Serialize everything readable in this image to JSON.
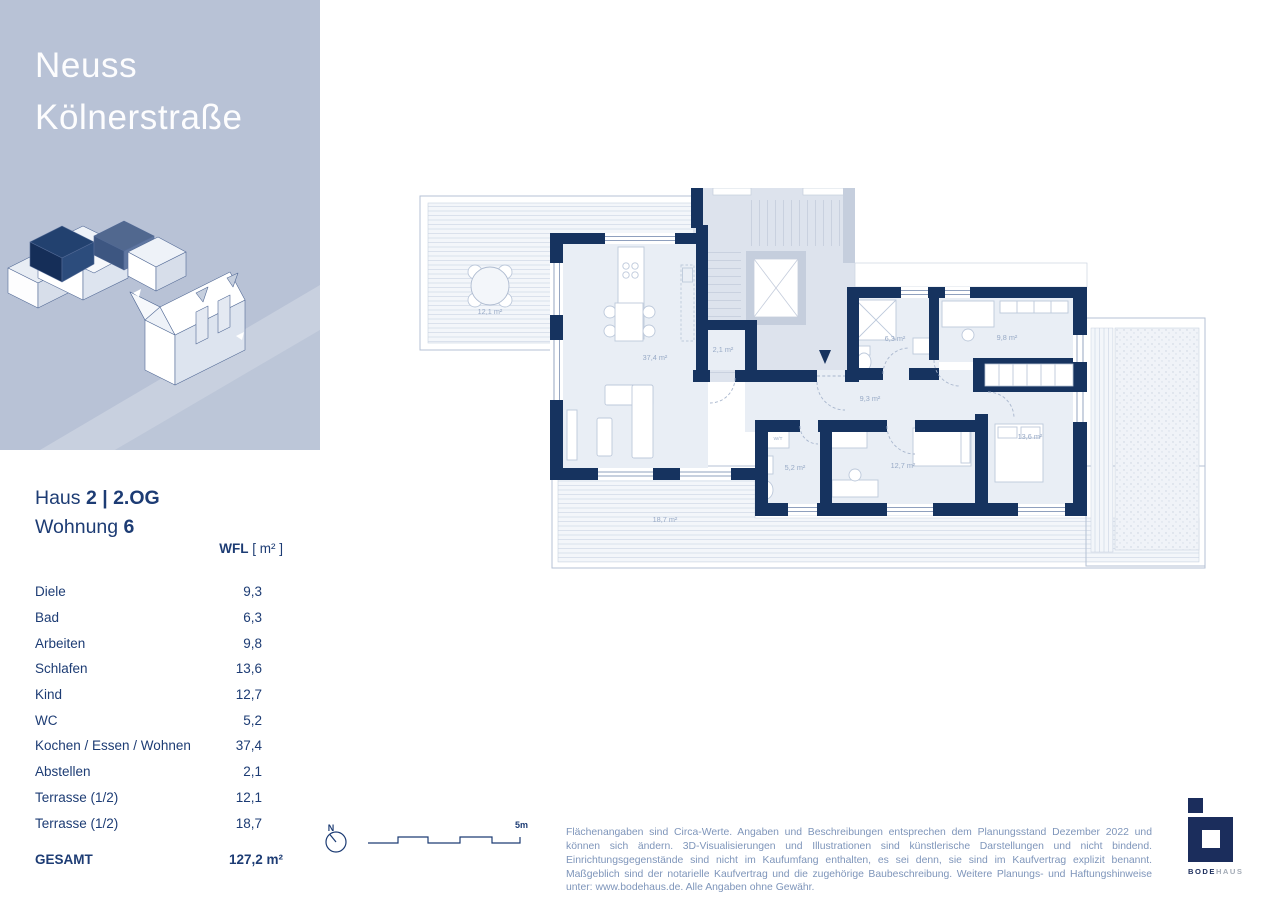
{
  "header": {
    "title_line1": "Neuss",
    "title_line2": "Kölnerstraße"
  },
  "unit": {
    "haus_prefix": "Haus",
    "haus_value": "2 | 2.OG",
    "wohnung_prefix": "Wohnung",
    "wohnung_value": "6"
  },
  "area_table": {
    "header_label": "WFL",
    "header_unit": "[ m² ]",
    "rows": [
      {
        "label": "Diele",
        "value": "9,3"
      },
      {
        "label": "Bad",
        "value": "6,3"
      },
      {
        "label": "Arbeiten",
        "value": "9,8"
      },
      {
        "label": "Schlafen",
        "value": "13,6"
      },
      {
        "label": "Kind",
        "value": "12,7"
      },
      {
        "label": "WC",
        "value": "5,2"
      },
      {
        "label": "Kochen / Essen / Wohnen",
        "value": "37,4"
      },
      {
        "label": "Abstellen",
        "value": "2,1"
      },
      {
        "label": "Terrasse (1/2)",
        "value": "12,1"
      },
      {
        "label": "Terrasse (1/2)",
        "value": "18,7"
      }
    ],
    "total": {
      "label": "GESAMT",
      "value": "127,2 m²"
    }
  },
  "plan": {
    "labels": {
      "terrasse_links": "12,1 m²",
      "kochen_essen_wohnen": "37,4 m²",
      "abstellen": "2,1 m²",
      "bad": "6,3 m²",
      "arbeiten": "9,8 m²",
      "diele": "9,3 m²",
      "wc": "5,2 m²",
      "kind": "12,7 m²",
      "schlafen": "13,6 m²",
      "terrasse_unten": "18,7 m²",
      "waschtrockner": "W/T"
    }
  },
  "compass": {
    "north_label": "N",
    "scale_label": "5m"
  },
  "footer": {
    "disclaimer": "Flächenangaben sind Circa-Werte. Angaben und Beschreibungen entsprechen dem Planungsstand Dezember 2022 und können sich ändern. 3D-Visualisierungen und Illustrationen sind künstlerische Darstellungen und nicht bindend. Einrichtungsgegenstände sind nicht im Kaufumfang enthalten, es sei denn, sie sind im Kaufvertrag explizit benannt. Maßgeblich sind der notarielle Kaufvertrag und die zugehörige Baubeschreibung. Weitere Planungs- und Haftungshinweise unter: www.bodehaus.de. Alle Angaben ohne Gewähr."
  },
  "logo": {
    "text_primary": "BODE",
    "text_secondary": "HAUS"
  },
  "colors": {
    "panel_blue": "#b8c2d6",
    "wall_navy": "#16335f",
    "text_navy": "#1d3c74",
    "muted_label": "#98aac6"
  }
}
